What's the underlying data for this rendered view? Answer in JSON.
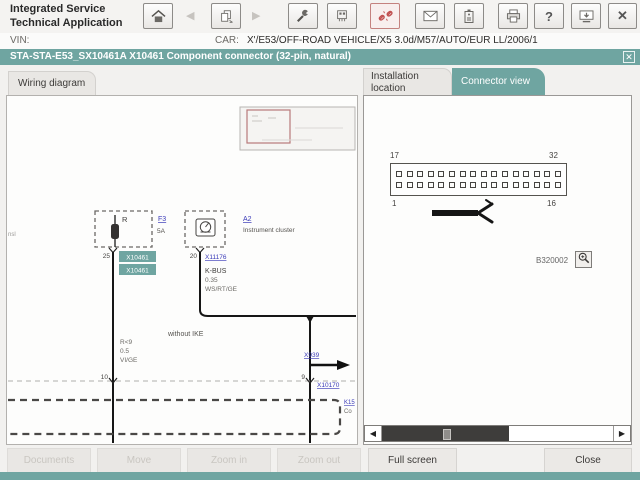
{
  "colors": {
    "teal": "#6FA5A1",
    "link": "#3A3AB8",
    "danger": "#C05050"
  },
  "header": {
    "title_line1": "Integrated Service",
    "title_line2": "Technical Application",
    "vin_label": "VIN:",
    "car_label": "CAR:",
    "car_value": "X'/E53/OFF-ROAD VEHICLE/X5 3.0d/M57/AUTO/EUR LL/2006/1"
  },
  "toolbar": {
    "back_glyph": "◀",
    "forward_glyph": "▶",
    "help_glyph": "?",
    "close_glyph": "✕"
  },
  "dialog": {
    "title": "STA-STA-E53_SX10461A X10461 Component connector (32-pin, natural)",
    "close_glyph": "✕"
  },
  "tabs": {
    "wiring_diagram": "Wiring diagram",
    "installation_location_line1": "Installation",
    "installation_location_line2": "location",
    "connector_view": "Connector view"
  },
  "diagram": {
    "edge_text": "nsl",
    "relay_label": "R",
    "fuse_link": "F3",
    "fuse_rating": "5A",
    "pin_25": "25",
    "connector_tag_1": "X10461",
    "connector_tag_2": "X10461",
    "cluster_link": "A2",
    "cluster_name": "Instrument cluster",
    "pin_20": "20",
    "link_x11176": "X11176",
    "bus_name": "K-BUS",
    "bus_cross_section": "0.35",
    "bus_wire_color": "WS/RT/GE",
    "note_without_ike": "without IKE",
    "wire_code": "R<9",
    "wire_cross_section": "0.5",
    "wire_color": "VI/GE",
    "link_x939": "X939",
    "pin_10": "10",
    "pin_9": "9",
    "link_x10170": "X10170",
    "link_k15": "K15",
    "k15_text": "Co",
    "pin_count_note": "32-pin"
  },
  "connector_view": {
    "pin_top_left": "17",
    "pin_top_right": "32",
    "pin_bottom_left": "1",
    "pin_bottom_right": "16",
    "pins_per_row": 16,
    "figure_id": "B320002",
    "scroll_left_glyph": "◀",
    "scroll_right_glyph": "▶"
  },
  "actions": {
    "documents": "Documents",
    "move": "Move",
    "zoom_in": "Zoom in",
    "zoom_out": "Zoom out",
    "full_screen": "Full screen",
    "close": "Close"
  }
}
